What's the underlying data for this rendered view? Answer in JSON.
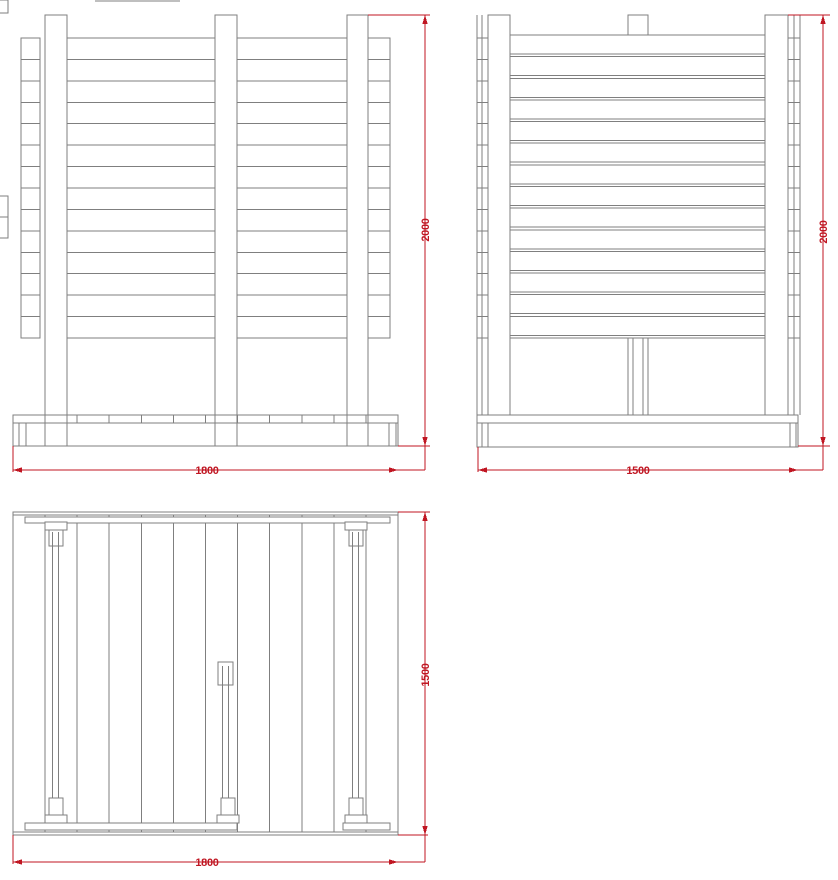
{
  "drawing": {
    "type": "technical-drawing-fence-deck",
    "colors": {
      "line": "#7f7f7f",
      "dimension": "#c01622",
      "background": "#ffffff"
    },
    "views": {
      "front_elevation": {
        "width_dim": "1800",
        "height_dim": "2000"
      },
      "side_elevation": {
        "width_dim": "1500",
        "height_dim": "2000"
      },
      "plan_view": {
        "width_dim": "1800",
        "height_dim": "1500"
      }
    }
  }
}
